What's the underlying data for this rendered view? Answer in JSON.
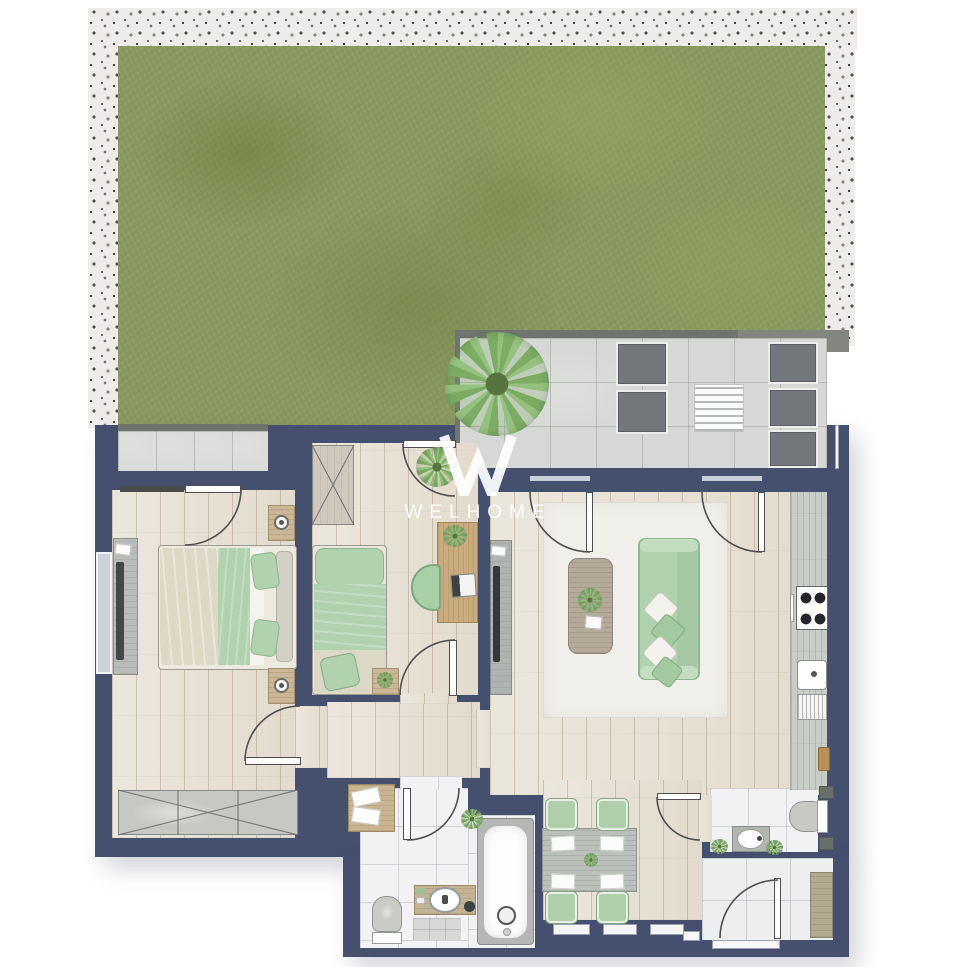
{
  "watermark": {
    "logo_letter": "W",
    "brand": "WELHOME"
  },
  "palette": {
    "background": "#ffffff",
    "wall": "#45506f",
    "grass": "#8a9a5e",
    "gravel": "#edecea",
    "terrace_tile": "#d5d8d4",
    "wood_floor": "#e8e2d6",
    "bath_tile": "#f2f2f4",
    "rug": "#f0efe9",
    "furniture_green": "#b0d2ae",
    "bedding_beige": "#ddd7c5",
    "furniture_wood": "#cbb795",
    "outdoor_gray": "#73767a",
    "counter_gray": "#c9cdc7",
    "line": "#4e4e4e"
  },
  "plan": {
    "type": "apartment-floor-plan-top-view",
    "outdoor_areas": [
      "garden-lawn",
      "gravel-border",
      "roof-terrace",
      "bedroom-patio"
    ],
    "rooms": [
      "bedroom-1",
      "bedroom-2",
      "hallway",
      "living-room",
      "kitchen",
      "dining-area",
      "bathroom",
      "wc",
      "entrance-hall"
    ],
    "furniture": {
      "terrace": [
        "palm-plant",
        "lounge-chair",
        "lounge-chair",
        "slatted-coffee-table",
        "outdoor-sofa-3-seats"
      ],
      "bedroom_1": [
        "double-bed",
        "nightstand-with-lamp",
        "nightstand-with-lamp",
        "dresser-with-tv",
        "wardrobe"
      ],
      "bedroom_2": [
        "single-bed",
        "bedside-table",
        "desk-with-laptop",
        "desk-chair",
        "wardrobe",
        "hanging-plant"
      ],
      "living_room": [
        "sofa-with-pillows",
        "coffee-table-with-plant",
        "rug",
        "tv-console"
      ],
      "kitchen": [
        "counter",
        "gas-hob",
        "sink",
        "dish-drainer",
        "cutting-board"
      ],
      "dining": [
        "table",
        "chair",
        "chair",
        "chair",
        "chair",
        "placemats",
        "center-plant"
      ],
      "bathroom": [
        "bathtub",
        "vanity-sink",
        "toilet",
        "towel-cabinet",
        "bath-mat",
        "plant"
      ],
      "wc": [
        "toilet",
        "sink",
        "plant",
        "plant"
      ],
      "entrance": [
        "tall-cabinet",
        "entry-door"
      ]
    }
  }
}
